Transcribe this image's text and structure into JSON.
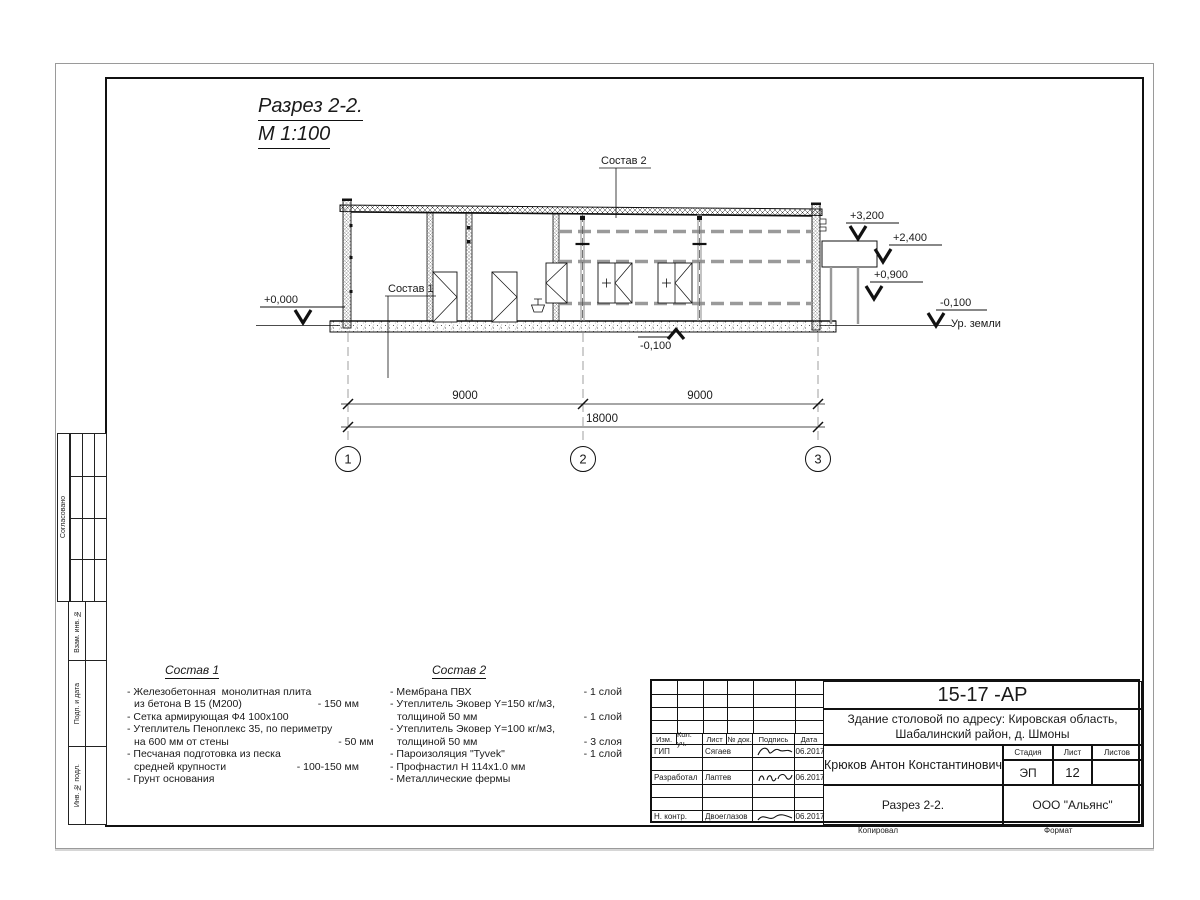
{
  "page": {
    "title": "Разрез 2-2.",
    "scale": "М 1:100"
  },
  "drawing": {
    "labels": {
      "sostav1": "Состав 1",
      "sostav2": "Состав 2"
    },
    "elevations": {
      "zero": "+0,000",
      "p3200": "+3,200",
      "p2400": "+2,400",
      "p0900": "+0,900",
      "m0100": "-0,100",
      "ground": "Ур. земли",
      "m0100_floor": "-0,100"
    },
    "dimensions": {
      "span1": "9000",
      "span2": "9000",
      "total": "18000"
    },
    "axes": {
      "a1": "1",
      "a2": "2",
      "a3": "3"
    }
  },
  "specs": [
    {
      "title": "Состав 1",
      "items": [
        {
          "lines": [
            "- Железобетонная  монолитная плита",
            "из бетона В 15 (М200)"
          ],
          "value": "- 150 мм"
        },
        {
          "lines": [
            "- Сетка армирующая Ф4 100х100"
          ],
          "value": ""
        },
        {
          "lines": [
            "- Утеплитель Пеноплекс 35, по периметру",
            "на 600 мм от стены"
          ],
          "value": "- 50 мм"
        },
        {
          "lines": [
            "- Песчаная подготовка из песка",
            "средней крупности"
          ],
          "value": "- 100-150 мм"
        },
        {
          "lines": [
            "- Грунт основания"
          ],
          "value": ""
        }
      ]
    },
    {
      "title": "Состав 2",
      "items": [
        {
          "lines": [
            "- Мембрана ПВХ"
          ],
          "value": "- 1 слой"
        },
        {
          "lines": [
            "- Утеплитель Эковер Y=150 кг/м3,",
            "толщиной 50 мм"
          ],
          "value": "- 1 слой"
        },
        {
          "lines": [
            "- Утеплитель Эковер Y=100 кг/м3,",
            "толщиной 50 мм"
          ],
          "value": "- 3 слоя"
        },
        {
          "lines": [
            "- Пароизоляция \"Tyvek\""
          ],
          "value": "- 1 слой"
        },
        {
          "lines": [
            "- Профнастил Н 114х1.0 мм"
          ],
          "value": ""
        },
        {
          "lines": [
            "- Металлические фермы"
          ],
          "value": ""
        }
      ]
    }
  ],
  "sidebar": {
    "agreed": "Согласовано",
    "vzam": "Взам. инв. №",
    "podp": "Подп. и дата",
    "inv": "Инв. № подл."
  },
  "titleblock": {
    "doc_number": "15-17 -АР",
    "project_line1": "Здание столовой по адресу: Кировская область,",
    "project_line2": "Шабалинский район, д. Шмоны",
    "cols": [
      "Изм.",
      "Кол. уч.",
      "Лист",
      "№ док.",
      "Подпись",
      "Дата"
    ],
    "rows": [
      {
        "role": "ГИП",
        "name": "Сягаев",
        "date": "06.2017"
      },
      {
        "role": "Разработал",
        "name": "Лаптев",
        "date": "06.2017"
      },
      {
        "role": "Н. контр.",
        "name": "Двоеглазов",
        "date": "06.2017"
      }
    ],
    "author": "Крюков Антон Константинович",
    "stage_label": "Стадия",
    "sheet_label": "Лист",
    "sheets_label": "Листов",
    "stage": "ЭП",
    "sheet": "12",
    "sheets": "",
    "drawing_name": "Разрез 2-2.",
    "company": "ООО \"Альянс\"",
    "copied": "Копировал",
    "format": "Формат"
  }
}
